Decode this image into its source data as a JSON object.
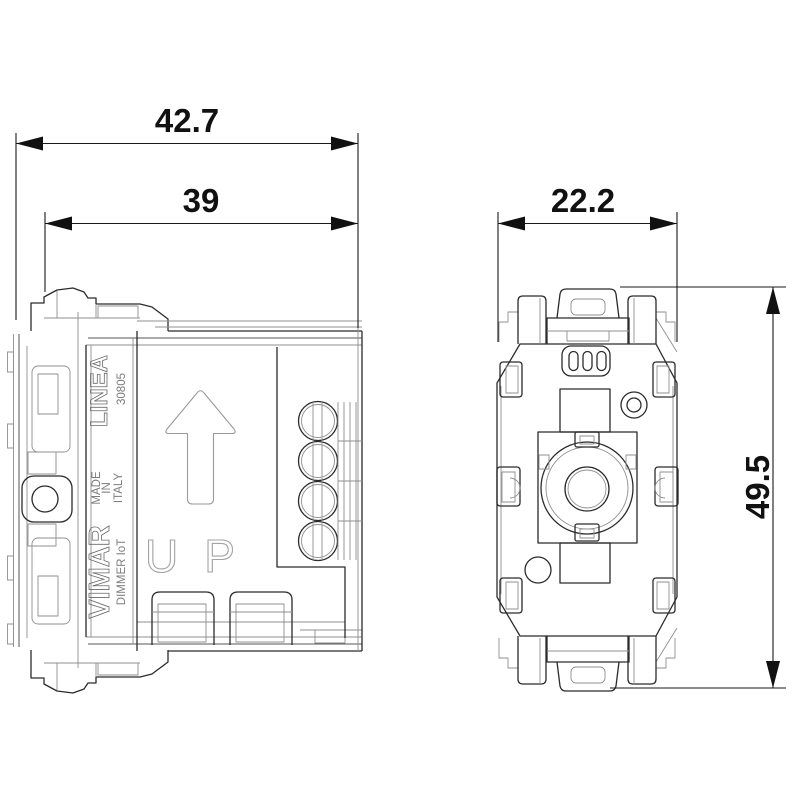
{
  "dimensions": {
    "overall_depth": "42.7",
    "inner_depth": "39",
    "width": "22.2",
    "height": "49.5"
  },
  "side_view": {
    "brand": "VIMAR",
    "series": "LINEA",
    "model": "30805",
    "made": [
      "MADE",
      "IN",
      "ITALY"
    ],
    "product": "DIMMER IoT",
    "orientation": "UP"
  },
  "colors": {
    "background": "#ffffff",
    "outline": "#2b2b2b",
    "detail_line": "#8f8f8f",
    "dimension": "#111111"
  }
}
